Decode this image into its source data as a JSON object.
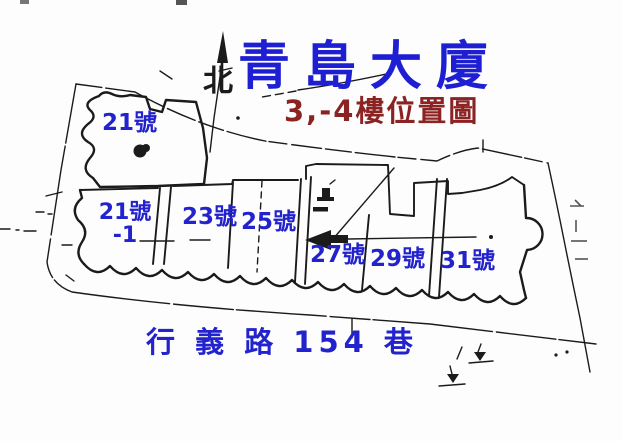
{
  "header": {
    "title": "青島大廈",
    "subtitle": "3,-4樓位置圖"
  },
  "north": {
    "label": "北"
  },
  "map": {
    "units": [
      {
        "id": "21",
        "label": "21號"
      },
      {
        "id": "21-1",
        "label": "21號",
        "suffix": "-1"
      },
      {
        "id": "23",
        "label": "23號"
      },
      {
        "id": "25",
        "label": "25號"
      },
      {
        "id": "27",
        "label": "27號"
      },
      {
        "id": "29",
        "label": "29號"
      },
      {
        "id": "31",
        "label": "31號"
      }
    ],
    "street": {
      "label": "行 義 路 154 巷"
    }
  },
  "colors": {
    "title-blue": "#1e1ed2",
    "label-blue": "#2323cd",
    "subtitle-red": "#8b2323",
    "ink": "#1b1b1b",
    "bg": "#fdfdfd"
  }
}
